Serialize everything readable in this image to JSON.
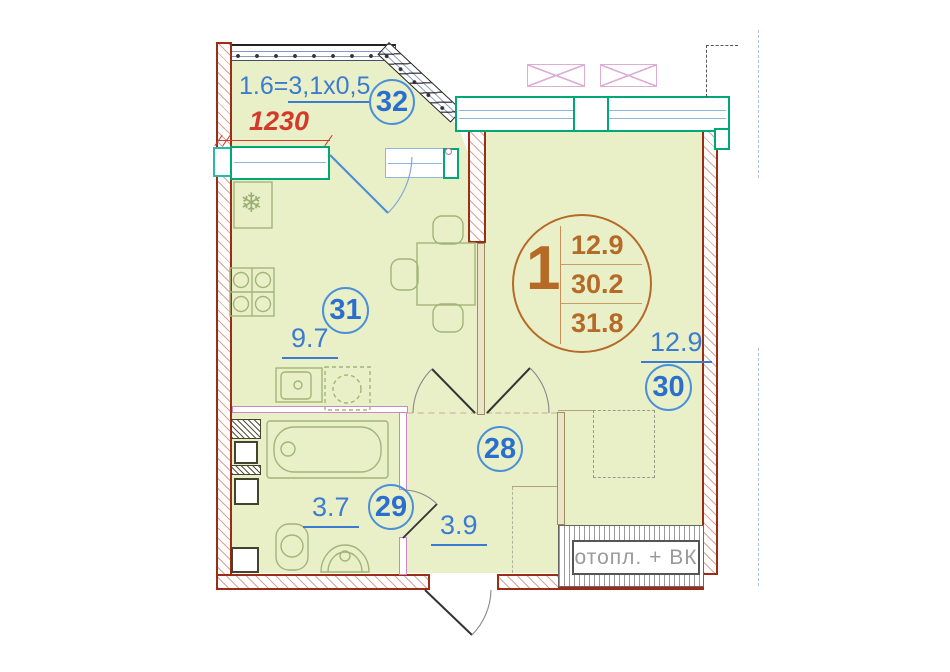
{
  "colors": {
    "room_fill": "#e9f0c8",
    "wall_red": "#9b2d18",
    "window_green": "#00a876",
    "label_blue": "#2b6fce",
    "dimension_red": "#d43a2a",
    "unit_brown": "#b56a28",
    "niche_gray": "#9a9a9a",
    "partition_pink": "#cf86c4",
    "furniture_olive": "#a3b478"
  },
  "labels": {
    "balcony_formula_prefix": "1.6=",
    "balcony_formula_value": "3,1x0,5",
    "dimension": "1230",
    "niche": "отопл. + ВК"
  },
  "unit_badge": {
    "number": "1",
    "values": [
      "12.9",
      "30.2",
      "31.8"
    ]
  },
  "rooms": [
    {
      "number": "32",
      "name": "balcony"
    },
    {
      "number": "31",
      "name": "kitchen",
      "area": "9.7"
    },
    {
      "number": "30",
      "name": "living-room",
      "area": "12.9"
    },
    {
      "number": "28",
      "name": "hallway",
      "area": "3.9"
    },
    {
      "number": "29",
      "name": "bathroom",
      "area": "3.7"
    }
  ],
  "icons": {
    "fridge": "❄"
  }
}
